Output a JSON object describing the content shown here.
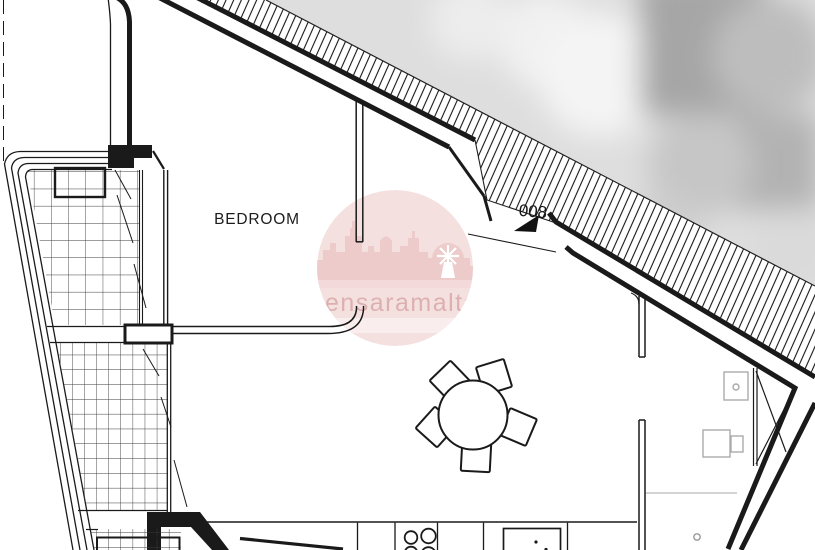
{
  "drawing": {
    "type": "apartment floor plan",
    "labels": {
      "room": "BEDROOM",
      "door_number": "008",
      "watermark": "sensaramalta"
    },
    "colors": {
      "background": "#ffffff",
      "linework": "#1a1a1a",
      "tile_grid": "#3a3a3a",
      "furniture_gray": "#aaaaaa",
      "watermark_circle": "#f5dfdf",
      "watermark_silhouette": "#ecc9c9",
      "watermark_band": "#f3d7d7",
      "watermark_pale_band": "#f9ecec",
      "watermark_text": "#dcacac",
      "photo_base_gray": "#dedede"
    },
    "elements": {
      "rooms": [
        "BEDROOM"
      ],
      "fixtures": [
        "round dining table with five chairs",
        "kitchen counter",
        "stove burners",
        "sink with faucet",
        "washer",
        "appliance",
        "shaft with cross bracing"
      ],
      "terrace": "tiled balcony with planter and step bands",
      "entrance": {
        "number": "008",
        "arrow": "solid triangle pointing lower-left"
      }
    }
  }
}
